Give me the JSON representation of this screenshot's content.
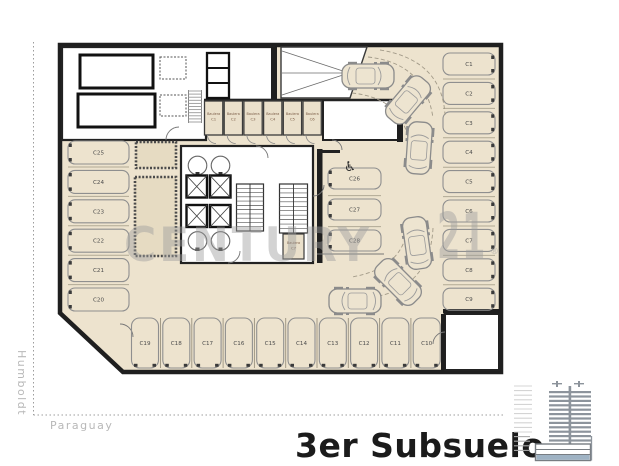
{
  "title": "3er Subsuelo",
  "streets": {
    "left": "Humboldt",
    "bottom": "Paraguay"
  },
  "watermark": {
    "brand": "CENTURY",
    "number": "21",
    "registered": "®"
  },
  "plan": {
    "accessible_icon": "♿",
    "parking": {
      "left_column": [
        "C25",
        "C24",
        "C23",
        "C22",
        "C21",
        "C20"
      ],
      "center_column": [
        "C26",
        "C27",
        "C28"
      ],
      "right_column": [
        "C1",
        "C2",
        "C3",
        "C4",
        "C5",
        "C6",
        "C7",
        "C8",
        "C9"
      ],
      "bottom_row": [
        "C19",
        "C18",
        "C17",
        "C16",
        "C15",
        "C14",
        "C13",
        "C12",
        "C11",
        "C10"
      ]
    },
    "storage": {
      "unit_label": "Baulera",
      "hall_units": [
        "C1",
        "C2",
        "C3",
        "C4",
        "C5",
        "C6"
      ],
      "core_unit": "C7"
    }
  },
  "colors": {
    "floor_beige": "#EDE3CE",
    "wall_dark": "#1F1F1F",
    "watermark_gray": "#9E9E9E",
    "basement_highlight": "#9FB3C4",
    "street_label_gray": "#B8B8B8"
  }
}
